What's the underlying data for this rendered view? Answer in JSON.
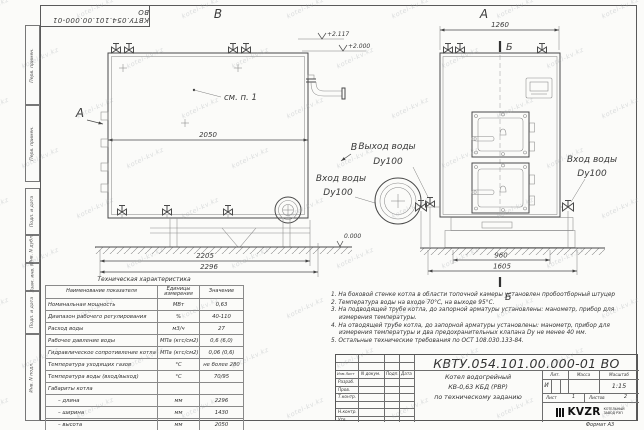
{
  "watermark": {
    "text": "kotel-kv.kz"
  },
  "frame": {
    "stamp_rotated": "КВТУ.054.101.00.000-01  ВО",
    "left_column": [
      "Перв. примен.",
      "Перв. примен.",
      "Подп. и дата",
      "Инв. N дубл.",
      "Взам. инв. N",
      "Подп. и дата",
      "Инв. N подл."
    ]
  },
  "drawing": {
    "view_b_title": "В",
    "view_a_title": "А",
    "arrow_a_label": "А",
    "marker_v_label": "В",
    "see_item": "см. п. 1",
    "elev_1": "+2.117",
    "elev_2": "+2.000",
    "elev_0": "0.000",
    "section_label_top": "Б",
    "section_label_bottom": "Б",
    "dims": {
      "side_top": "2050",
      "side_mid": "2205",
      "side_total": "2296",
      "front_top": "1260",
      "front_base": "960",
      "front_total": "1605"
    },
    "outlet_line1": "Выход воды",
    "outlet_line2": "Dy100",
    "inlet_side_line1": "Вход воды",
    "inlet_side_line2": "Dy100",
    "inlet_front_line1": "Вход воды",
    "inlet_front_line2": "Dy100"
  },
  "spec": {
    "title": "Техническая характеристика",
    "col1": "Наименование показателя",
    "col2_l1": "Единицы",
    "col2_l2": "измерения",
    "col3": "Значение",
    "rows": [
      {
        "name": "Номинальная мощность",
        "unit": "МВт",
        "value": "0,63"
      },
      {
        "name": "Диапазон рабочего регулирования",
        "unit": "%",
        "value": "40-110"
      },
      {
        "name": "Расход воды",
        "unit": "м3/ч",
        "value": "27"
      },
      {
        "name": "Рабочее давление воды",
        "unit": "МПа (кгс/см2)",
        "value": "0,6 (6,0)"
      },
      {
        "name": "Гидравлическое сопротивление котла",
        "unit": "МПа (кгс/см2)",
        "value": "0,06 (0,6)"
      },
      {
        "name": "Температура уходящих газов",
        "unit": "°С",
        "value": "не более 280"
      },
      {
        "name": "Температура воды (вход/выход)",
        "unit": "°С",
        "value": "70/95"
      },
      {
        "name": "Габариты котла",
        "unit": "",
        "value": ""
      },
      {
        "name": "– длина",
        "unit": "мм",
        "value": "2296"
      },
      {
        "name": "– ширина",
        "unit": "мм",
        "value": "1430"
      },
      {
        "name": "– высота",
        "unit": "мм",
        "value": "2050"
      }
    ]
  },
  "notes": {
    "items": [
      "1.  На боковой стенке котла в области топочной камеры установлен пробоотборный штуцер",
      "2.  Температура воды на входе 70°С, на выходе 95°С.",
      "3.  На подводящей трубе котла, до запорной арматуры установлены: манометр, прибор для измерения температуры.",
      "4.  На отводящей трубе котла, до запорной арматуры установлены: манометр, прибор для измерения температуры и два предохранительных клапана Dу не менее 40 мм.",
      "5.  Остальные технические требования по ОСТ 108.030.133-84."
    ]
  },
  "tb": {
    "doc_number": "КВТУ.054.101.00.000-01  ВО",
    "h_izm": "Изм.Лист",
    "h_doc": "N докум.",
    "h_sign": "Подп.",
    "h_date": "Дата",
    "r1": "Разраб.",
    "r2": "Пров.",
    "r3": "Т.контр.",
    "r4": "",
    "r5": "Н.контр.",
    "r6": "Утв.",
    "name1": "Котел водогрейный",
    "name2": "КВ-0,63  КБД  (РВР)",
    "name3": "по техническому заданию",
    "lit_h": "Лит.",
    "mass_h": "Масса",
    "scale_h": "Масштаб",
    "lit_v": "И",
    "scale_v": "1:15",
    "sheet_h": "Лист",
    "sheet_v": "1",
    "sheets_h": "Листов",
    "sheets_v": "2",
    "logo": "KVZR",
    "logo_sub1": "КОТЕЛЬНЫЙ",
    "logo_sub2": "ЗАВОД РЭП",
    "format": "Формат   А3"
  }
}
